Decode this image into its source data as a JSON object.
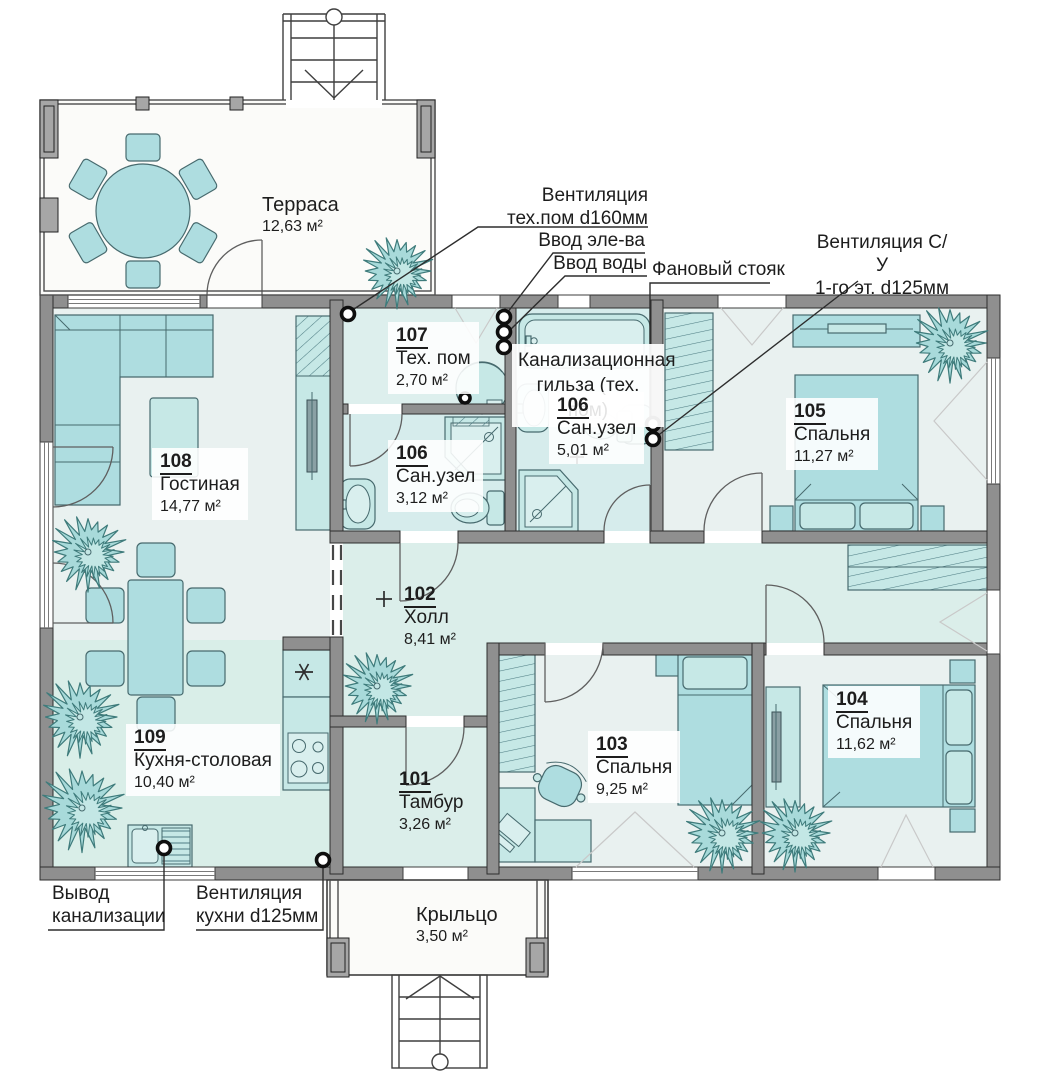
{
  "palette": {
    "wall": "#8f8f8f",
    "furniture": "#aedde0",
    "furniture_light": "#c6e8e6",
    "room_cool": "#e9f1f0",
    "room_teal": "#dbeeea",
    "bath_teal": "#d6ecec",
    "plant": "#a8dada",
    "line": "#2d2d2d"
  },
  "rooms": {
    "tambour": {
      "number": "101",
      "name": "Тамбур",
      "area": "3,26 м²"
    },
    "hall": {
      "number": "102",
      "name": "Холл",
      "area": "8,41 м²"
    },
    "bedroom103": {
      "number": "103",
      "name": "Спальня",
      "area": "9,25 м²"
    },
    "bedroom104": {
      "number": "104",
      "name": "Спальня",
      "area": "11,62 м²"
    },
    "bedroom105": {
      "number": "105",
      "name": "Спальня",
      "area": "11,27 м²"
    },
    "bath_small": {
      "number": "106",
      "name": "Сан.узел",
      "area": "3,12 м²"
    },
    "bath_big": {
      "number": "106",
      "name": "Сан.узел",
      "area": "5,01 м²"
    },
    "tech": {
      "number": "107",
      "name": "Тех. пом",
      "area": "2,70 м²"
    },
    "living": {
      "number": "108",
      "name": "Гостиная",
      "area": "14,77 м²"
    },
    "kitchen": {
      "number": "109",
      "name": "Кухня-столовая",
      "area": "10,40 м²"
    }
  },
  "outdoor": {
    "terrace": {
      "name": "Терраса",
      "area": "12,63 м²"
    },
    "porch": {
      "name": "Крыльцо",
      "area": "3,50 м²"
    }
  },
  "annotations": {
    "vent_tech": {
      "line1": "Вентиляция",
      "line2": "тех.пом d160мм"
    },
    "power_inlet": {
      "text": "Ввод эле-ва"
    },
    "water_inlet": {
      "text": "Ввод воды"
    },
    "sewer_stack": {
      "text": "Фановый стояк"
    },
    "vent_su": {
      "line1": "Вентиляция С/У",
      "line2": "1-го эт. d125мм"
    },
    "sewer_outlet": {
      "line1": "Вывод",
      "line2": "канализации"
    },
    "vent_kitchen": {
      "line1": "Вентиляция",
      "line2": "кухни d125мм"
    },
    "sleeve_note": {
      "text": "Канализационная гильза (тех. пом)"
    }
  }
}
